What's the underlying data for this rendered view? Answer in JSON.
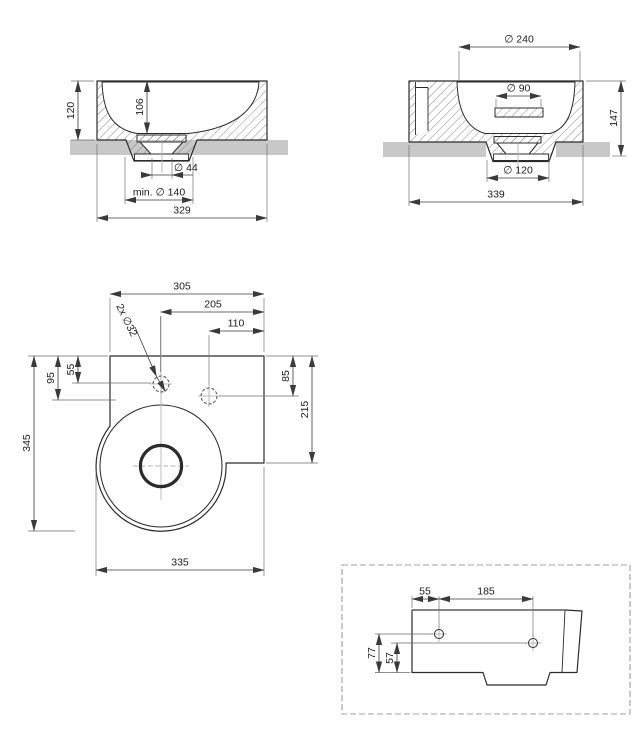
{
  "front_view": {
    "height": "120",
    "bowl_depth": "106",
    "drain_hole": "∅ 44",
    "min_clearance": "min. ∅ 140",
    "overall_width": "329"
  },
  "side_view": {
    "bowl_diameter": "∅ 240",
    "waste_cover": "∅ 90",
    "height": "147",
    "base_width": "∅ 120",
    "overall_depth": "339"
  },
  "plan_view": {
    "width_to_left_edge": "305",
    "hole1_from_right": "205",
    "hole2_from_right": "110",
    "tap_holes": "2x ∅32",
    "hole1_from_top": "55",
    "bowl_from_top": "95",
    "overall_depth": "345",
    "hole2_from_top": "85",
    "ledge_depth": "215",
    "overall_width": "335"
  },
  "detail_view": {
    "hole1_from_left": "55",
    "hole_spacing": "185",
    "hole1_from_bottom": "77",
    "hole2_from_bottom": "57"
  },
  "colors": {
    "surface_band": "#c8c8c8",
    "outline": "#2b2b2b",
    "dimension": "#3a3a3a",
    "centerline": "#b5b5b5",
    "detail_border": "#a0a0a0"
  }
}
